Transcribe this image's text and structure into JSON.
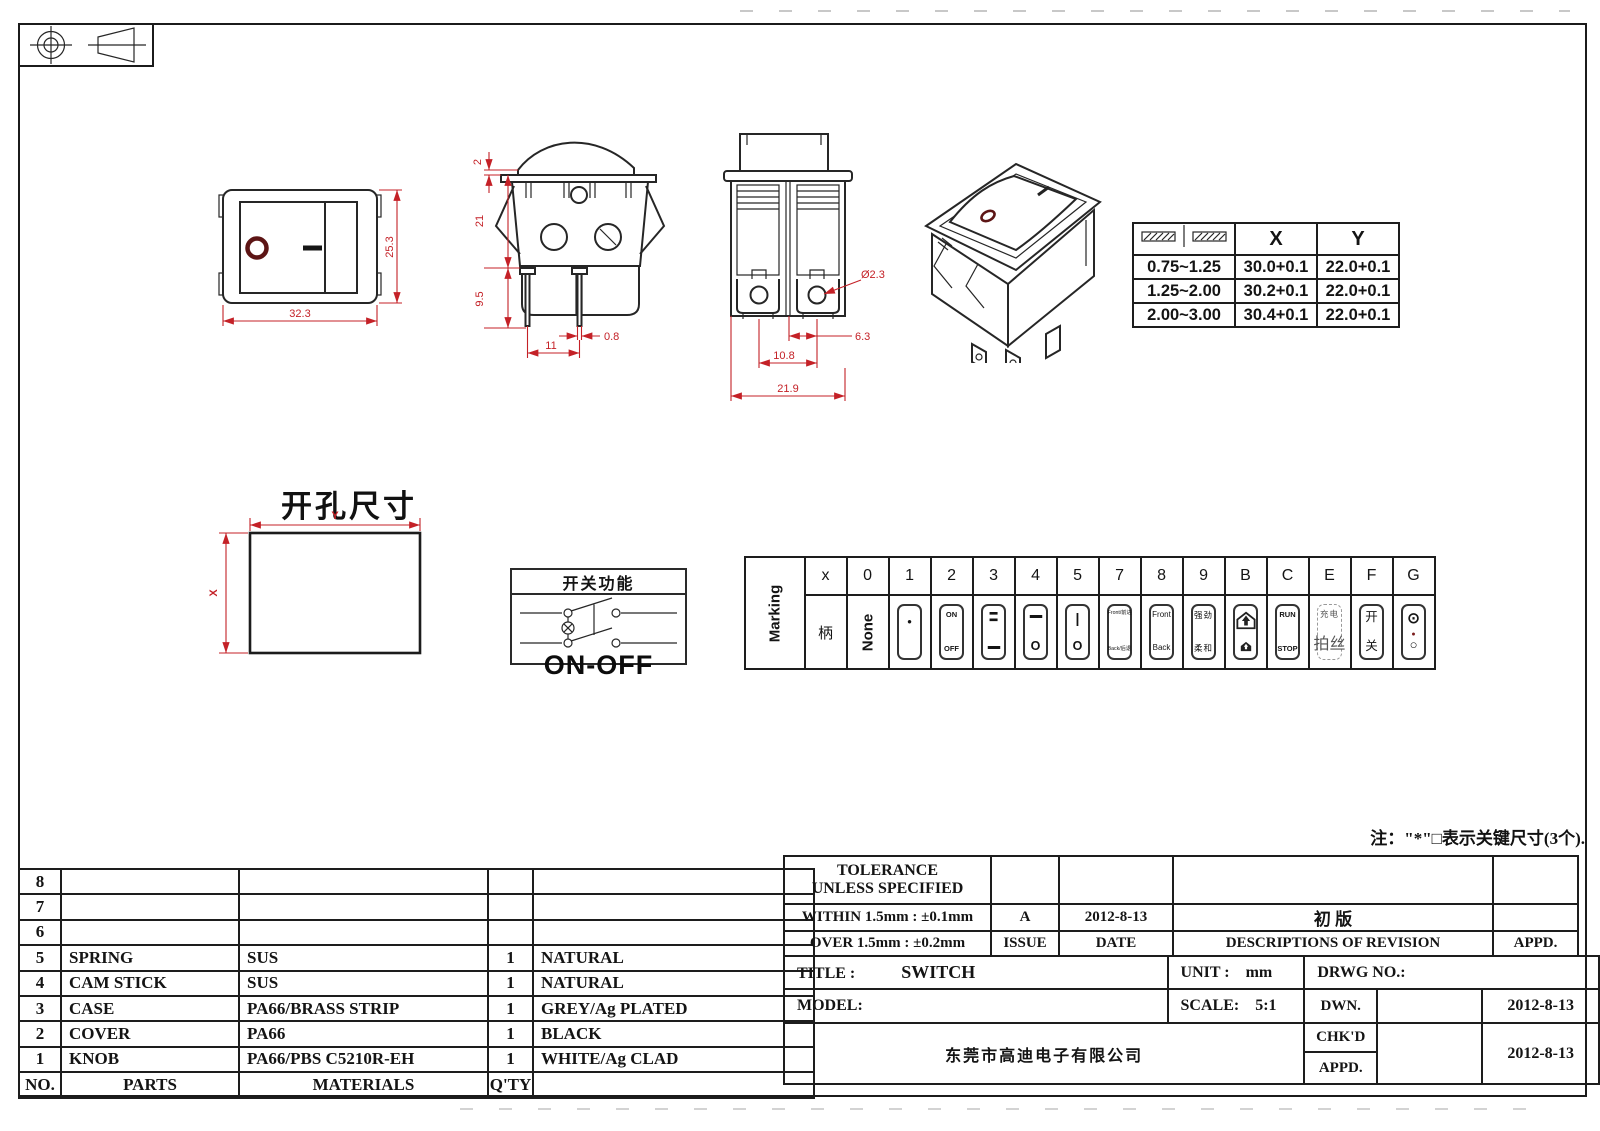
{
  "sheet": {
    "note": "注：\"*\"□表示关键尺寸(3个).",
    "projection_icons": [
      "circle-crosshair-icon",
      "truncated-cone-icon"
    ]
  },
  "views": {
    "front": {
      "dim_width": "32.3",
      "dim_height": "25.3",
      "legend_off": "O",
      "legend_on": "—"
    },
    "side": {
      "dim_rocker": "2",
      "dim_body": "21",
      "dim_pins": "9.5",
      "dim_pin_w": "0.8",
      "dim_pitch": "11"
    },
    "end": {
      "dim_hole": "Ø2.3",
      "dim_hole_offset": "6.3",
      "dim_pitch": "10.8",
      "dim_width": "21.9"
    },
    "iso": {
      "legend_off": "O",
      "legend_on": "|"
    }
  },
  "panel": {
    "thickness_icon": "panel-thickness-icon",
    "col_x": "X",
    "col_y": "Y",
    "rows": [
      {
        "t": "0.75~1.25",
        "x": "30.0+0.1",
        "y": "22.0+0.1"
      },
      {
        "t": "1.25~2.00",
        "x": "30.2+0.1",
        "y": "22.0+0.1"
      },
      {
        "t": "2.00~3.00",
        "x": "30.4+0.1",
        "y": "22.0+0.1"
      }
    ]
  },
  "cutout": {
    "title": "开孔尺寸",
    "label_x": "X",
    "label_y": "Y"
  },
  "func": {
    "title": "开关功能",
    "caption": "ON-OFF",
    "lamp_icon": "lamp-symbol-icon"
  },
  "marking": {
    "side_label": "Marking",
    "h": [
      "x",
      "0",
      "1",
      "2",
      "3",
      "4",
      "5",
      "7",
      "8",
      "9",
      "B",
      "C",
      "E",
      "F",
      "G"
    ],
    "cells": {
      "x": "柄",
      "0": "None",
      "1": [
        "•",
        ""
      ],
      "2": [
        "ON",
        "OFF"
      ],
      "3": [
        "=",
        "▬"
      ],
      "4": [
        "▬",
        "O"
      ],
      "5": [
        "|",
        "O"
      ],
      "7": [
        "Front/前进",
        "Back/后退"
      ],
      "8": [
        "Front",
        "Back"
      ],
      "9": [
        "强劲",
        "柔和"
      ],
      "B": [
        "boost-arrow-house-icon",
        "boost-arrow-house-small-icon"
      ],
      "C": [
        "RUN",
        "STOP"
      ],
      "E": [
        "充电",
        "拍丝"
      ],
      "F": [
        "开",
        "关"
      ],
      "G": [
        "⊙",
        "○"
      ],
      "G_dot": "●"
    }
  },
  "bom": {
    "headers": {
      "no": "NO.",
      "parts": "PARTS",
      "materials": "MATERIALS",
      "qty": "Q'TY",
      "remark": ""
    },
    "rows": [
      {
        "no": "8",
        "parts": "",
        "materials": "",
        "qty": "",
        "remark": ""
      },
      {
        "no": "7",
        "parts": "",
        "materials": "",
        "qty": "",
        "remark": ""
      },
      {
        "no": "6",
        "parts": "",
        "materials": "",
        "qty": "",
        "remark": ""
      },
      {
        "no": "5",
        "parts": "SPRING",
        "materials": "SUS",
        "qty": "1",
        "remark": "NATURAL"
      },
      {
        "no": "4",
        "parts": "CAM STICK",
        "materials": "SUS",
        "qty": "1",
        "remark": "NATURAL"
      },
      {
        "no": "3",
        "parts": "CASE",
        "materials": "PA66/BRASS STRIP",
        "qty": "1",
        "remark": "GREY/Ag PLATED"
      },
      {
        "no": "2",
        "parts": "COVER",
        "materials": "PA66",
        "qty": "1",
        "remark": "BLACK"
      },
      {
        "no": "1",
        "parts": "KNOB",
        "materials": "PA66/PBS C5210R-EH",
        "qty": "1",
        "remark": "WHITE/Ag CLAD"
      }
    ]
  },
  "titleblock": {
    "tolerance_line1": "TOLERANCE",
    "tolerance_line2": "UNLESS  SPECIFIED",
    "within": "WITHIN 1.5mm : ±0.1mm",
    "over": "OVER 1.5mm : ±0.2mm",
    "issue_value": "A",
    "issue_label": "ISSUE",
    "date_value": "2012-8-13",
    "date_label": "DATE",
    "revision_value": "初 版",
    "revision_label": "DESCRIPTIONS OF REVISION",
    "revision_appd": "APPD.",
    "title_label": "TITLE :",
    "title_value": "SWITCH",
    "unit_label": "UNIT :",
    "unit_value": "mm",
    "drwg_label": "DRWG NO.:",
    "model_label": "MODEL:",
    "scale_label": "SCALE:",
    "scale_value": "5:1",
    "dwn_label": "DWN.",
    "dwn_date": "2012-8-13",
    "chkd_label": "CHK'D",
    "chkd_date": "2012-8-13",
    "appd_label": "APPD.",
    "company": "东莞市高迪电子有限公司"
  },
  "colors": {
    "dim_red": "#c42127",
    "legend_maroon": "#5d1515",
    "line": "#262626"
  }
}
